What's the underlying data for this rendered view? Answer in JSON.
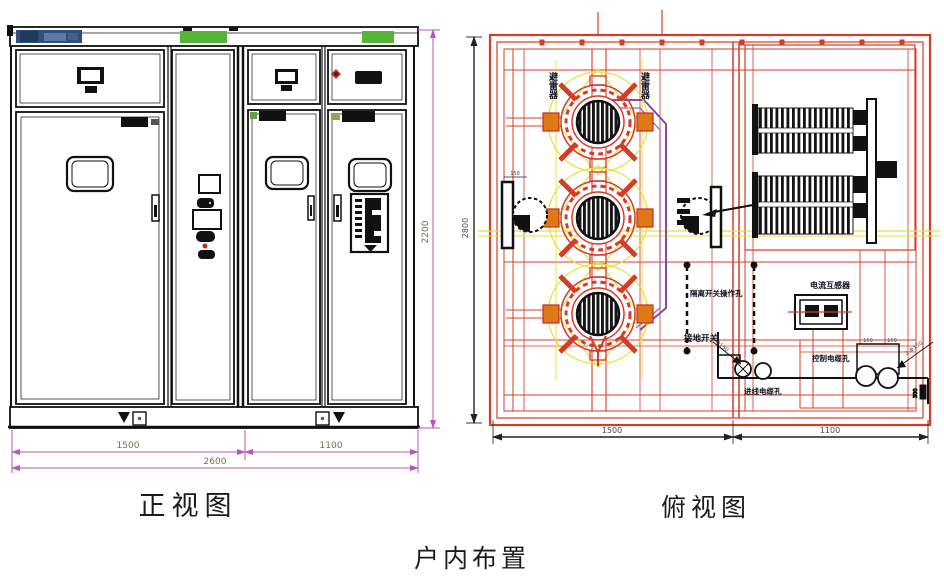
{
  "title": "户内布置",
  "front_view": {
    "caption": "正视图",
    "dim_height": "2200",
    "dim_left": "1500",
    "dim_right": "1100",
    "dim_total": "2600"
  },
  "top_view": {
    "caption": "俯视图",
    "dim_depth": "2800",
    "dim_left": "1500",
    "dim_right": "1100",
    "label_arrester_a": "避雷器",
    "label_arrester_b": "避雷器",
    "label_disconnector": "隔离开关操作孔",
    "label_earth_switch": "接地开关",
    "label_ct": "电流互感器",
    "label_cable_in": "进线电缆孔",
    "label_cable_ctrl": "控制电缆孔",
    "leader_left": "2-Φ150",
    "leader_right": "2-Φ150",
    "dim_150_a": "150",
    "dim_150_b": "150",
    "dim_150_fan": "150",
    "dim_300": "300"
  },
  "colors": {
    "red": "#d43c2a",
    "yellow": "#e4e03a",
    "purple": "#8a4a9c",
    "orange": "#e07818",
    "green_strip": "#55b335",
    "blue_nameplate": "#2e4f7d",
    "magenta_dim": "#b855b8"
  }
}
